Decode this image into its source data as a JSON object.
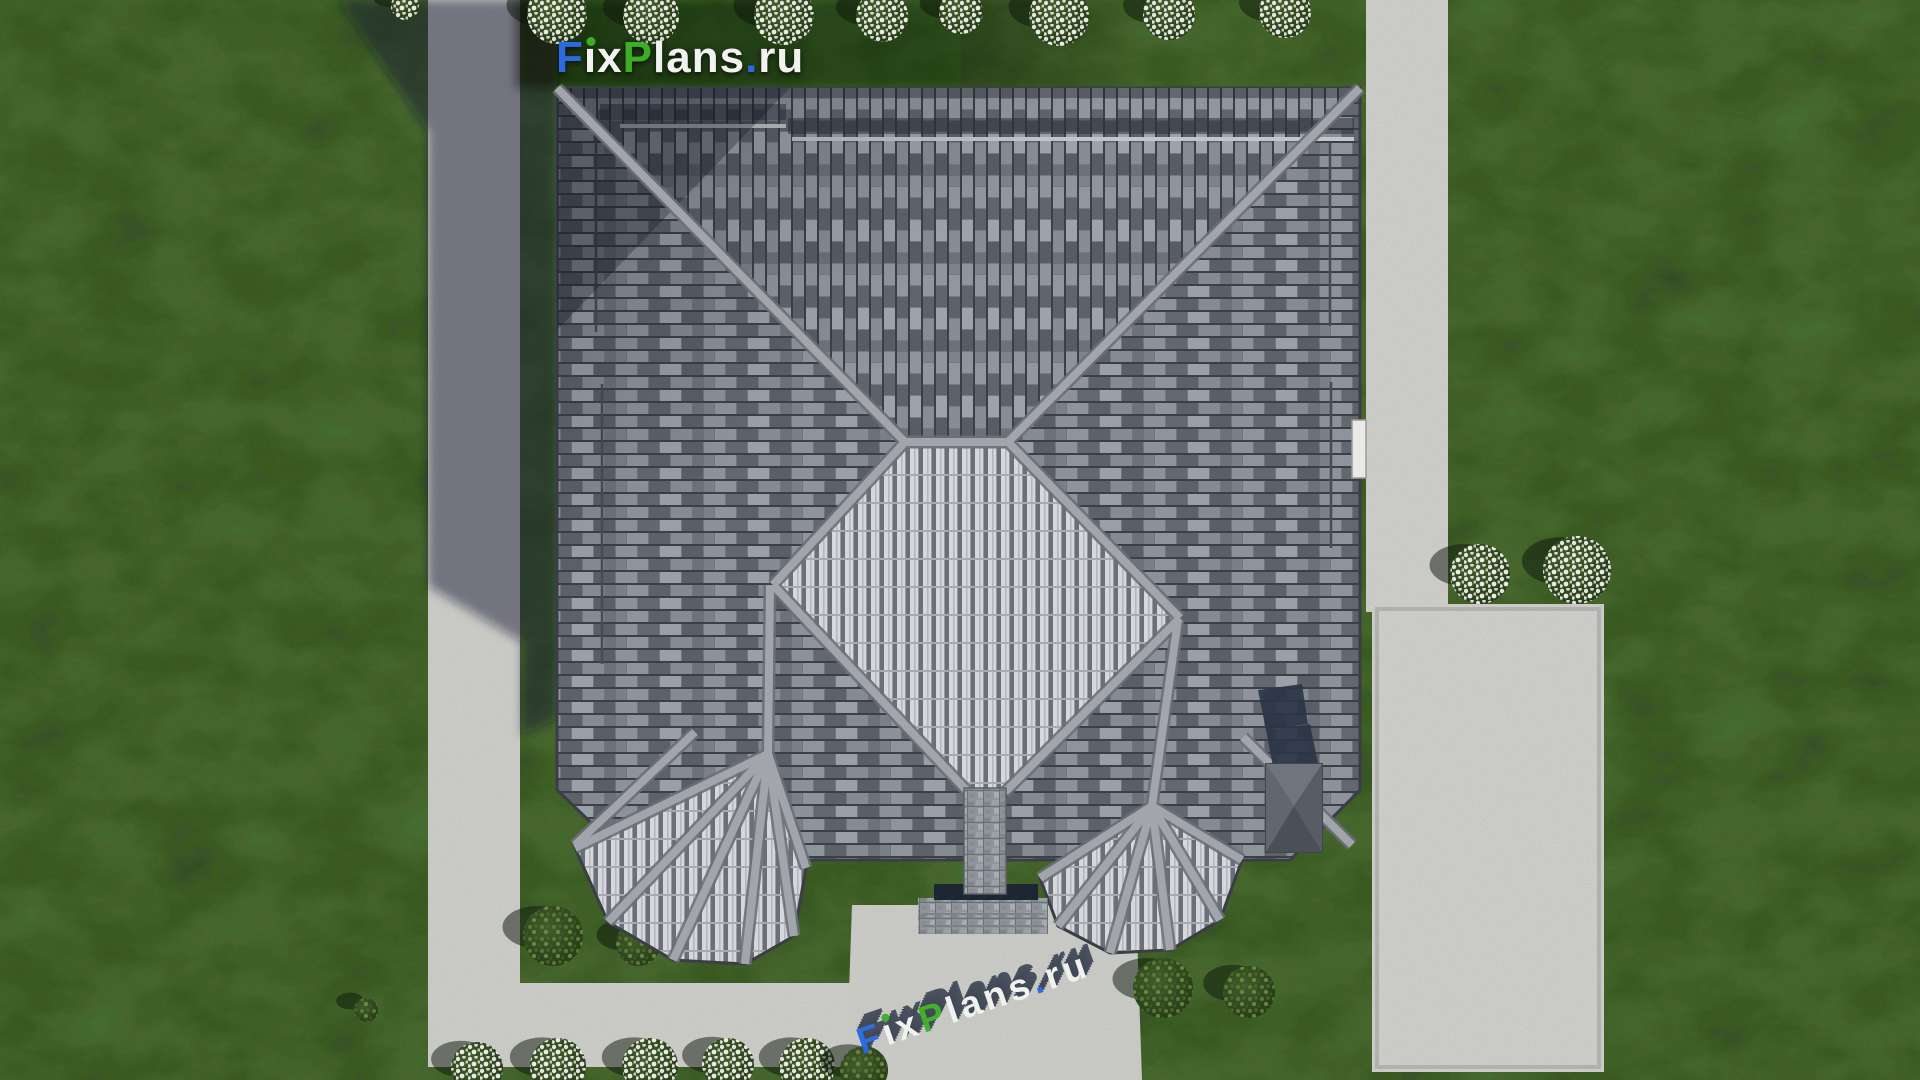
{
  "branding": {
    "logo_text": "FixPlans.ru",
    "letters": [
      {
        "ch": "F",
        "color": "#2b6ae0"
      },
      {
        "ch": "i",
        "render": "ı",
        "color": "#f2f3f1",
        "dot": "#3fae27"
      },
      {
        "ch": "x",
        "color": "#f2f3f1"
      },
      {
        "ch": "P",
        "color": "#3fae27"
      },
      {
        "ch": "l",
        "color": "#f2f3f1"
      },
      {
        "ch": "a",
        "color": "#f2f3f1"
      },
      {
        "ch": "n",
        "color": "#f2f3f1"
      },
      {
        "ch": "s",
        "color": "#f2f3f1"
      },
      {
        "ch": ".",
        "color": "#2b6ae0"
      },
      {
        "ch": "r",
        "color": "#f2f3f1"
      },
      {
        "ch": "u",
        "color": "#f2f3f1"
      }
    ],
    "watermark_text": "FixPlans.ru",
    "watermark_extrusion_color": "#424957"
  },
  "palette": {
    "lawn_green": "#52743a",
    "lawn_shadow": "#18260f",
    "concrete": "#d0d1cd",
    "concrete_border": "#b5b6b2",
    "cast_shadow": "#101c30",
    "roof_tile_mid": "#71757d",
    "roof_tile_light": "#d6d8dc",
    "roof_tile_dark": "#3b3f47",
    "roof_ridge": "#a2a5ab",
    "step_navy": "#1d2734",
    "chimney_gray": "#5b5f67",
    "stone_gray": "#949aa0",
    "flower_white": "#eceee8",
    "shrub_green": "#46682c",
    "logo_blue": "#2b6ae0",
    "logo_green": "#3fae27",
    "logo_white": "#f2f3f1"
  }
}
